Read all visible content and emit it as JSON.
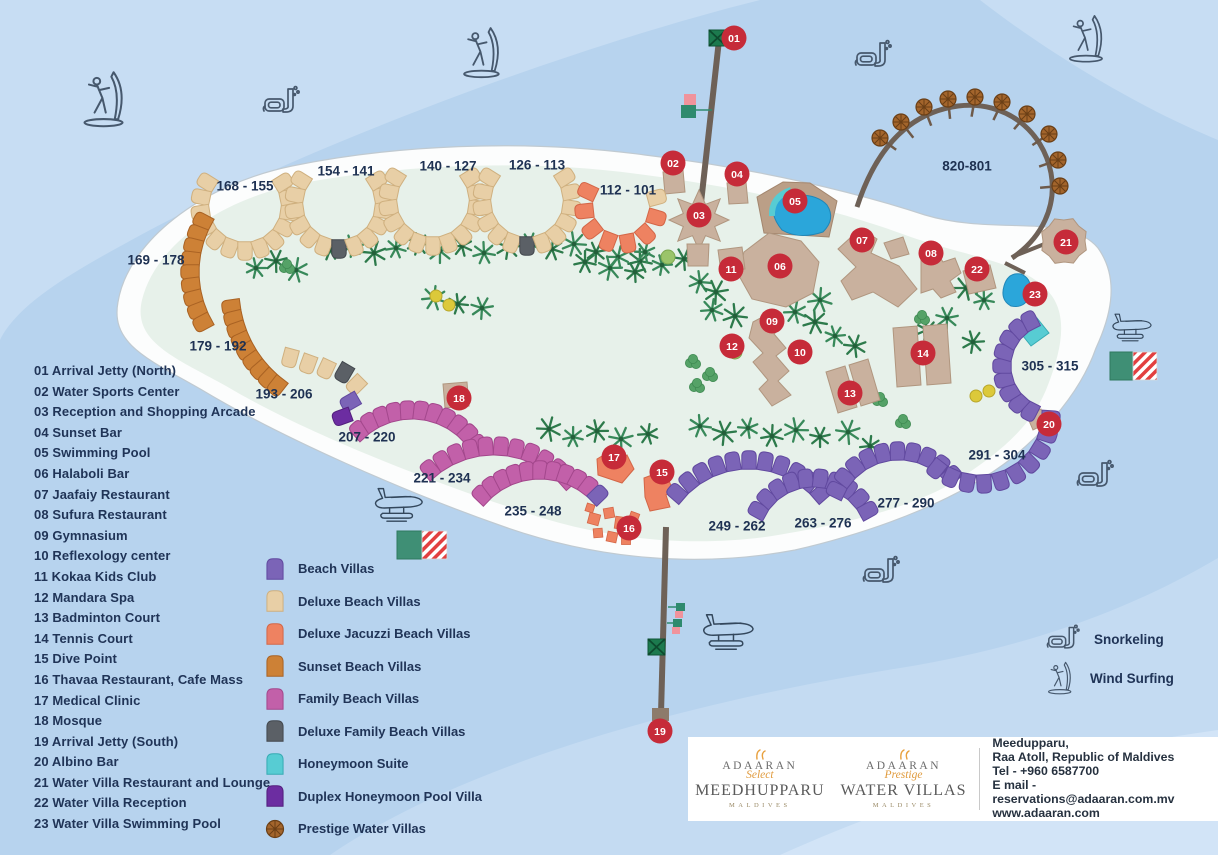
{
  "facilities": [
    {
      "num": "01",
      "label": "Arrival Jetty (North)",
      "x": 734,
      "y": 38
    },
    {
      "num": "02",
      "label": "Water Sports Center",
      "x": 673,
      "y": 163
    },
    {
      "num": "03",
      "label": "Reception and Shopping Arcade",
      "x": 699,
      "y": 215
    },
    {
      "num": "04",
      "label": "Sunset Bar",
      "x": 737,
      "y": 174
    },
    {
      "num": "05",
      "label": "Swimming Pool",
      "x": 795,
      "y": 201
    },
    {
      "num": "06",
      "label": "Halaboli Bar",
      "x": 780,
      "y": 266
    },
    {
      "num": "07",
      "label": "Jaafaiy Restaurant",
      "x": 862,
      "y": 240
    },
    {
      "num": "08",
      "label": "Sufura Restaurant",
      "x": 931,
      "y": 253
    },
    {
      "num": "09",
      "label": "Gymnasium",
      "x": 772,
      "y": 321
    },
    {
      "num": "10",
      "label": "Reflexology center",
      "x": 800,
      "y": 352
    },
    {
      "num": "11",
      "label": "Kokaa Kids Club",
      "x": 731,
      "y": 269
    },
    {
      "num": "12",
      "label": "Mandara Spa",
      "x": 732,
      "y": 346
    },
    {
      "num": "13",
      "label": "Badminton Court",
      "x": 850,
      "y": 393
    },
    {
      "num": "14",
      "label": "Tennis Court",
      "x": 923,
      "y": 353
    },
    {
      "num": "15",
      "label": "Dive Point",
      "x": 662,
      "y": 472
    },
    {
      "num": "16",
      "label": "Thavaa Restaurant, Cafe Mass",
      "x": 629,
      "y": 528
    },
    {
      "num": "17",
      "label": "Medical Clinic",
      "x": 614,
      "y": 457
    },
    {
      "num": "18",
      "label": "Mosque",
      "x": 459,
      "y": 398
    },
    {
      "num": "19",
      "label": "Arrival Jetty (South)",
      "x": 660,
      "y": 731
    },
    {
      "num": "20",
      "label": "Albino Bar",
      "x": 1049,
      "y": 424
    },
    {
      "num": "21",
      "label": "Water Villa Restaurant and Lounge",
      "x": 1066,
      "y": 242
    },
    {
      "num": "22",
      "label": "Water Villa Reception",
      "x": 977,
      "y": 269
    },
    {
      "num": "23",
      "label": "Water Villa Swimming Pool",
      "x": 1035,
      "y": 294
    }
  ],
  "villa_legend": [
    {
      "key": "beach",
      "label": "Beach Villas"
    },
    {
      "key": "deluxe",
      "label": "Deluxe Beach Villas"
    },
    {
      "key": "jacuzzi",
      "label": "Deluxe Jacuzzi Beach Villas"
    },
    {
      "key": "sunset",
      "label": "Sunset Beach Villas"
    },
    {
      "key": "family",
      "label": "Family Beach Villas"
    },
    {
      "key": "dfamily",
      "label": "Deluxe Family Beach Villas"
    },
    {
      "key": "honeymoon",
      "label": "Honeymoon Suite"
    },
    {
      "key": "duplex",
      "label": "Duplex Honeymoon Pool Villa"
    },
    {
      "key": "prestige",
      "label": "Prestige Water Villas"
    }
  ],
  "activities": [
    {
      "icon": "snorkel",
      "label": "Snorkeling"
    },
    {
      "icon": "windsurf",
      "label": "Wind Surfing"
    }
  ],
  "footer": {
    "brand1": {
      "top": "ADAARAN",
      "script": "Select",
      "main": "MEEDHUPPARU",
      "sub": "MALDIVES"
    },
    "brand2": {
      "top": "ADAARAN",
      "script": "Prestige",
      "main": "WATER VILLAS",
      "sub": "MALDIVES"
    },
    "address_lines": [
      "Meedupparu,",
      "Raa Atoll, Republic of Maldives",
      "Tel - +960 6587700",
      "E mail - reservations@adaaran.com.mv",
      "www.adaaran.com"
    ]
  },
  "palette": {
    "beach": {
      "f": "#7b64b7",
      "s": "#61499f"
    },
    "deluxe": {
      "f": "#e8cfa6",
      "s": "#cfb07f"
    },
    "jacuzzi": {
      "f": "#ee8261",
      "s": "#d36647"
    },
    "sunset": {
      "f": "#cd8136",
      "s": "#a96223"
    },
    "family": {
      "f": "#c260a9",
      "s": "#a3478c"
    },
    "dfamily": {
      "f": "#5b6066",
      "s": "#43484e"
    },
    "honeymoon": {
      "f": "#57ccd3",
      "s": "#36abb3"
    },
    "duplex": {
      "f": "#6c2da1",
      "s": "#531f7d"
    },
    "prestige": {
      "f": "#a3652c",
      "s": "#6b3f16"
    },
    "tan": {
      "f": "#c9b19e",
      "s": "#b0967f"
    },
    "tan2": {
      "f": "#bb9f87",
      "s": "#a3866e"
    },
    "pool": {
      "f": "#2ba6da",
      "s": "#2187b8"
    },
    "marker": "#c62b39",
    "label": "#1e3152"
  },
  "map": {
    "chains": [
      {
        "label": "168 - 155",
        "lx": 245,
        "ly": 187,
        "color": "deluxe",
        "cx": 245,
        "cy": 206,
        "r": 45,
        "a0": 212,
        "a1": -32,
        "n": 13
      },
      {
        "label": "154 - 141",
        "lx": 346,
        "ly": 172,
        "color": "deluxe",
        "cx": 339,
        "cy": 204,
        "r": 45,
        "a0": 212,
        "a1": -32,
        "n": 13,
        "ov": {
          "6": "dfamily"
        }
      },
      {
        "label": "140 - 127",
        "lx": 448,
        "ly": 167,
        "color": "deluxe",
        "cx": 433,
        "cy": 201,
        "r": 45,
        "a0": 212,
        "a1": -32,
        "n": 13
      },
      {
        "label": "126 - 113",
        "lx": 537,
        "ly": 166,
        "color": "deluxe",
        "cx": 527,
        "cy": 201,
        "r": 45,
        "a0": 212,
        "a1": -32,
        "n": 13,
        "ov": {
          "6": "dfamily"
        }
      },
      {
        "label": "112 - 101",
        "lx": 628,
        "ly": 191,
        "color": "jacuzzi",
        "cx": 621,
        "cy": 207,
        "r": 37,
        "a0": 205,
        "a1": -15,
        "n": 8,
        "ov": {
          "7": "deluxe"
        }
      },
      {
        "label": "169 - 178",
        "lx": 156,
        "ly": 261,
        "color": "sunset",
        "cx": 298,
        "cy": 272,
        "r": 108,
        "a0": 208,
        "a1": 152,
        "n": 9
      },
      {
        "label": "179 - 192",
        "lx": 218,
        "ly": 347,
        "color": "sunset",
        "cx": 352,
        "cy": 290,
        "r": 122,
        "a0": 172,
        "a1": 128,
        "n": 9
      },
      {
        "label": "193 - 206",
        "lx": 284,
        "ly": 395,
        "color": "deluxe",
        "pts": [
          [
            290,
            358,
            195
          ],
          [
            308,
            364,
            200
          ],
          [
            326,
            369,
            205
          ],
          [
            344,
            373,
            210
          ],
          [
            356,
            385,
            225
          ],
          [
            350,
            402,
            240
          ],
          [
            342,
            417,
            250
          ]
        ],
        "ov": {
          "3": "dfamily",
          "5": "beach",
          "6": "duplex"
        }
      },
      {
        "label": "207 - 220",
        "lx": 367,
        "ly": 438,
        "color": "family",
        "cx": 412,
        "cy": 489,
        "r": 79,
        "a0": 228,
        "a1": 325,
        "n": 11
      },
      {
        "label": "221 - 234",
        "lx": 442,
        "ly": 479,
        "color": "family",
        "cx": 494,
        "cy": 546,
        "r": 100,
        "a0": 230,
        "a1": 318,
        "n": 11
      },
      {
        "label": "235 - 248",
        "lx": 533,
        "ly": 512,
        "color": "family",
        "cx": 540,
        "cy": 551,
        "r": 81,
        "a0": 224,
        "a1": 316,
        "n": 11,
        "ov": {
          "10": "beach"
        }
      },
      {
        "label": "249 - 262",
        "lx": 737,
        "ly": 527,
        "color": "beach",
        "cx": 749,
        "cy": 556,
        "r": 96,
        "a0": 221,
        "a1": 319,
        "n": 11
      },
      {
        "label": "263 - 276",
        "lx": 823,
        "ly": 524,
        "color": "beach",
        "cx": 813,
        "cy": 541,
        "r": 63,
        "a0": 209,
        "a1": 331,
        "n": 10
      },
      {
        "label": "277 - 290",
        "lx": 906,
        "ly": 504,
        "color": "beach",
        "cx": 899,
        "cy": 521,
        "r": 70,
        "a0": 206,
        "a1": 319,
        "n": 10
      },
      {
        "label": "291 - 304",
        "lx": 997,
        "ly": 456,
        "color": "beach",
        "cx": 980,
        "cy": 413,
        "r": 71,
        "a0": 128,
        "a1": 4,
        "n": 10
      },
      {
        "label": "305 - 315",
        "lx": 1050,
        "ly": 367,
        "color": "beach",
        "cx": 1053,
        "cy": 366,
        "r": 51,
        "a0": 117,
        "a1": 243,
        "n": 9
      }
    ],
    "umbrella_arc": {
      "label": "820-801",
      "lx": 967,
      "ly": 167,
      "path": "M857,207 C878,142 914,112 958,106 C1006,100 1043,131 1051,173 C1057,206 1042,238 1012,258",
      "stubs": [
        "M1012,257 L1047,243",
        "M1005,263 L1025,273"
      ],
      "umbrellas": [
        [
          880,
          138
        ],
        [
          901,
          122
        ],
        [
          924,
          107
        ],
        [
          948,
          99
        ],
        [
          975,
          97
        ],
        [
          1002,
          102
        ],
        [
          1027,
          114
        ],
        [
          1049,
          134
        ],
        [
          1058,
          160
        ],
        [
          1060,
          186
        ]
      ],
      "stem_target": [
        958,
        195
      ]
    },
    "buildings": [
      {
        "name": "building-water-sports",
        "f": "tan",
        "pts": "663,172 683,170 685,192 665,194"
      },
      {
        "name": "building-sunset-bar",
        "f": "tan",
        "pts": "727,183 746,182 748,203 729,204"
      },
      {
        "name": "building-reception",
        "f": "tan",
        "star": [
          699,
          220,
          30,
          17,
          8,
          0
        ]
      },
      {
        "name": "building-reception-annex",
        "f": "tan",
        "pts": "687,244 709,244 708,266 688,266"
      },
      {
        "name": "building-pool-deck",
        "f": "tan2",
        "pts": "757,197 783,182 810,183 837,201 829,237 764,233"
      },
      {
        "name": "swimming-pool",
        "f": "pool",
        "path": "M776,199 Q812,189 827,205 Q836,219 823,232 Q799,240 782,230 Q768,213 776,199 Z"
      },
      {
        "name": "pool-rim",
        "stroke": "#57ccd3",
        "w": 6,
        "path": "M772,216 Q771,197 791,190"
      },
      {
        "name": "building-halaboli-bar",
        "f": "tan",
        "pts": "744,252 769,233 801,241 819,262 813,293 786,307 752,299 738,274"
      },
      {
        "name": "building-kids-club",
        "f": "tan",
        "pts": "718,250 742,247 745,269 721,272"
      },
      {
        "name": "building-jaafaiy-restaurant",
        "f": "tan",
        "pts": "838,249 861,228 877,239 871,253 899,266 917,289 898,307 873,292 852,300 841,281 856,267"
      },
      {
        "name": "building-jaafaiy-wing",
        "f": "tan",
        "pts": "884,243 903,237 909,254 891,259"
      },
      {
        "name": "building-sufura-restaurant",
        "f": "tan",
        "pts": "921,259 936,251 943,262 955,258 961,273 950,281 956,292 941,298 933,289 921,293"
      },
      {
        "name": "building-water-villa-reception",
        "f": "tan",
        "pts": "963,271 990,265 996,288 969,294"
      },
      {
        "name": "building-water-villa-restaurant",
        "f": "tan",
        "star": [
          1064,
          241,
          24,
          21,
          8,
          22
        ]
      },
      {
        "name": "water-villa-swimming-pool",
        "f": "pool",
        "path": "M1004,286 Q1008,272 1021,274 Q1033,279 1030,295 Q1025,309 1011,306 Q1000,300 1004,286 Z"
      },
      {
        "name": "honeymoon-suite",
        "f": "honeymoon",
        "pts": "1019,331 1037,318 1049,333 1031,346"
      },
      {
        "name": "building-gym-spa-complex",
        "f": "tan",
        "pts": "753,322 772,312 783,326 774,334 786,348 776,356 789,371 778,381 791,395 772,406 759,389 768,380 753,362 763,353 749,338"
      },
      {
        "name": "badminton-court",
        "f": "tan",
        "pts": "826,372 845,366 857,407 838,413"
      },
      {
        "name": "badminton-court",
        "f": "tan",
        "pts": "849,365 868,359 880,400 861,406"
      },
      {
        "name": "tennis-court",
        "f": "tan",
        "pts": "893,328 917,326 921,385 897,387"
      },
      {
        "name": "tennis-court",
        "f": "tan",
        "pts": "923,326 947,324 951,383 927,385"
      },
      {
        "name": "building-mosque",
        "f": "tan",
        "pts": "443,384 467,382 469,406 445,408"
      },
      {
        "name": "building-medical-clinic",
        "f": "jacuzzi",
        "pts": "597,459 612,450 619,461 627,455 634,469 622,483 598,475"
      },
      {
        "name": "building-dive-point",
        "f": "jacuzzi",
        "pts": "644,478 665,470 673,491 666,495 670,507 650,511 645,497"
      },
      {
        "name": "building-albino-bar",
        "f": "tan",
        "pts": "1027,416 1041,409 1047,423 1033,430"
      }
    ],
    "cafe_squares": [
      [
        594,
        519,
        11,
        15
      ],
      [
        609,
        513,
        10,
        -10
      ],
      [
        621,
        523,
        12,
        8
      ],
      [
        634,
        517,
        9,
        20
      ],
      [
        598,
        533,
        9,
        -5
      ],
      [
        612,
        537,
        10,
        12
      ],
      [
        626,
        540,
        9,
        0
      ],
      [
        590,
        508,
        8,
        18
      ]
    ],
    "trees": {
      "p": [
        [
          256,
          268
        ],
        [
          276,
          261
        ],
        [
          296,
          270
        ],
        [
          330,
          250
        ],
        [
          352,
          246
        ],
        [
          374,
          253
        ],
        [
          396,
          248
        ],
        [
          418,
          244
        ],
        [
          440,
          251
        ],
        [
          462,
          246
        ],
        [
          484,
          253
        ],
        [
          508,
          247
        ],
        [
          530,
          243
        ],
        [
          552,
          249
        ],
        [
          574,
          244
        ],
        [
          596,
          252
        ],
        [
          618,
          257
        ],
        [
          640,
          261
        ],
        [
          662,
          265
        ],
        [
          684,
          259
        ],
        [
          434,
          298
        ],
        [
          458,
          304
        ],
        [
          482,
          308
        ],
        [
          549,
          429
        ],
        [
          573,
          437
        ],
        [
          597,
          431
        ],
        [
          621,
          439
        ],
        [
          648,
          434
        ],
        [
          700,
          426
        ],
        [
          724,
          433
        ],
        [
          748,
          428
        ],
        [
          772,
          436
        ],
        [
          796,
          430
        ],
        [
          820,
          437
        ],
        [
          795,
          312
        ],
        [
          815,
          322
        ],
        [
          835,
          336
        ],
        [
          855,
          346
        ],
        [
          820,
          300
        ],
        [
          927,
          330
        ],
        [
          947,
          318
        ],
        [
          966,
          288
        ],
        [
          984,
          300
        ],
        [
          973,
          342
        ],
        [
          848,
          432
        ],
        [
          870,
          446
        ],
        [
          700,
          282
        ],
        [
          716,
          292
        ],
        [
          645,
          252
        ],
        [
          585,
          262
        ],
        [
          610,
          268
        ],
        [
          635,
          272
        ],
        [
          712,
          310
        ],
        [
          735,
          316
        ]
      ],
      "b": [
        [
          287,
          267
        ],
        [
          693,
          362
        ],
        [
          710,
          375
        ],
        [
          697,
          386
        ],
        [
          880,
          400
        ],
        [
          903,
          422
        ],
        [
          922,
          318
        ]
      ],
      "bl": [
        [
          668,
          257
        ],
        [
          735,
          352
        ]
      ],
      "y": [
        [
          436,
          296
        ],
        [
          449,
          305
        ],
        [
          976,
          396
        ],
        [
          989,
          391
        ]
      ]
    },
    "planes": [
      {
        "x": 372,
        "y": 486,
        "s": 0.88
      },
      {
        "x": 700,
        "y": 612,
        "s": 0.93
      },
      {
        "x": 1110,
        "y": 312,
        "s": 0.72
      }
    ],
    "snorkels": [
      {
        "x": 262,
        "y": 84
      },
      {
        "x": 854,
        "y": 38
      },
      {
        "x": 1076,
        "y": 458
      },
      [
        862,
        554
      ]
    ],
    "windsurfers": [
      {
        "x": 80,
        "y": 70,
        "s": 1.12
      },
      {
        "x": 460,
        "y": 26,
        "s": 1.02
      },
      {
        "x": 1066,
        "y": 14,
        "s": 0.95
      }
    ],
    "flags": [
      {
        "gx": 397,
        "gy": 531,
        "gw": 25,
        "gh": 28,
        "sx": 422,
        "sy": 531,
        "sw": 25,
        "sh": 28
      },
      {
        "gx": 1110,
        "gy": 352,
        "gw": 23,
        "gh": 28,
        "sx": 1133,
        "sy": 352,
        "sw": 24,
        "sh": 28
      }
    ],
    "xsquares": [
      [
        709,
        30,
        17
      ],
      [
        648,
        639,
        17
      ]
    ],
    "jetty_marks": {
      "rects": [
        [
          684,
          94,
          12,
          11,
          "#f0939c"
        ],
        [
          681,
          105,
          15,
          13,
          "#2f8a6e"
        ],
        [
          676,
          603,
          9,
          8,
          "#2f8a6e"
        ],
        [
          675,
          611,
          8,
          7,
          "#f0939c"
        ],
        [
          673,
          619,
          9,
          8,
          "#2f8a6e"
        ],
        [
          672,
          627,
          8,
          7,
          "#f0939c"
        ],
        [
          652,
          708,
          17,
          13,
          "#8d7b6b"
        ]
      ],
      "lines": [
        "M696,110 L712,110",
        "M685,607 L668,607",
        "M682,623 L667,623"
      ]
    }
  }
}
